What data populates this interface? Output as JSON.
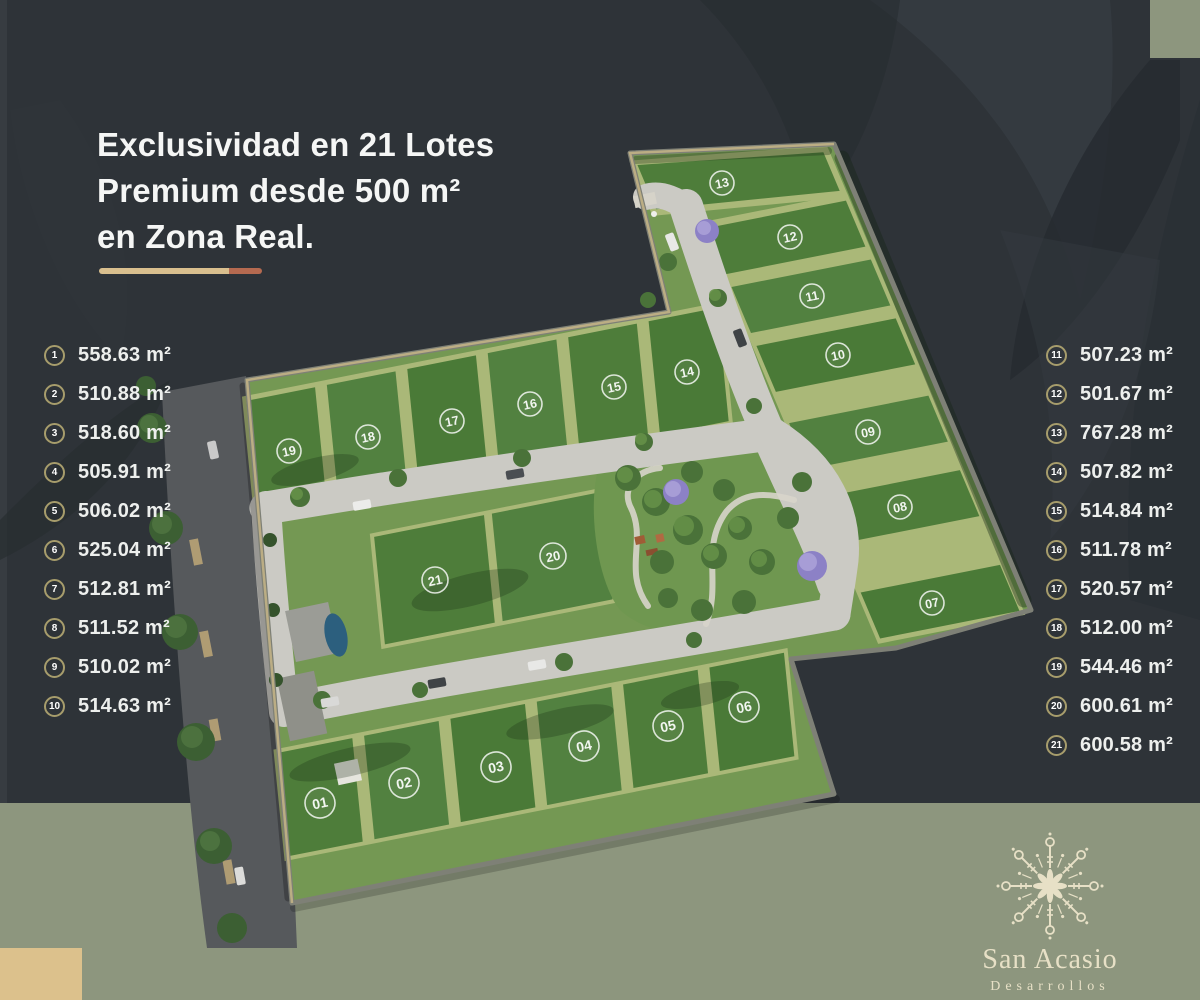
{
  "headline": {
    "line1": "Exclusividad en 21 Lotes",
    "line2": "Premium desde 500 m²",
    "line3": "en Zona Real."
  },
  "lots": [
    {
      "num": "1",
      "map": "01",
      "area": "558.63 m²"
    },
    {
      "num": "2",
      "map": "02",
      "area": "510.88 m²"
    },
    {
      "num": "3",
      "map": "03",
      "area": "518.60 m²"
    },
    {
      "num": "4",
      "map": "04",
      "area": "505.91 m²"
    },
    {
      "num": "5",
      "map": "05",
      "area": "506.02 m²"
    },
    {
      "num": "6",
      "map": "06",
      "area": "525.04 m²"
    },
    {
      "num": "7",
      "map": "07",
      "area": "512.81 m²"
    },
    {
      "num": "8",
      "map": "08",
      "area": "511.52 m²"
    },
    {
      "num": "9",
      "map": "09",
      "area": "510.02 m²"
    },
    {
      "num": "10",
      "map": "10",
      "area": "514.63 m²"
    },
    {
      "num": "11",
      "map": "11",
      "area": "507.23 m²"
    },
    {
      "num": "12",
      "map": "12",
      "area": "501.67 m²"
    },
    {
      "num": "13",
      "map": "13",
      "area": "767.28 m²"
    },
    {
      "num": "14",
      "map": "14",
      "area": "507.82 m²"
    },
    {
      "num": "15",
      "map": "15",
      "area": "514.84 m²"
    },
    {
      "num": "16",
      "map": "16",
      "area": "511.78 m²"
    },
    {
      "num": "17",
      "map": "17",
      "area": "520.57 m²"
    },
    {
      "num": "18",
      "map": "18",
      "area": "512.00 m²"
    },
    {
      "num": "19",
      "map": "19",
      "area": "544.46 m²"
    },
    {
      "num": "20",
      "map": "20",
      "area": "600.61 m²"
    },
    {
      "num": "21",
      "map": "21",
      "area": "600.58 m²"
    }
  ],
  "logo": {
    "name": "San Acasio",
    "subtitle": "Desarrollos"
  },
  "colors": {
    "background": "#2e3338",
    "sage_band": "#8d967e",
    "beige_accent": "#dcc18c",
    "divider_tan": "#d9bf8e",
    "divider_terracotta": "#b56a50",
    "list_circle_ring": "#a79d6c",
    "lot_green": "#4e7d3a",
    "lot_separator": "#aab878",
    "road": "#cbcac4",
    "street": "#56595c",
    "logo_cream": "#e7e0c6"
  }
}
